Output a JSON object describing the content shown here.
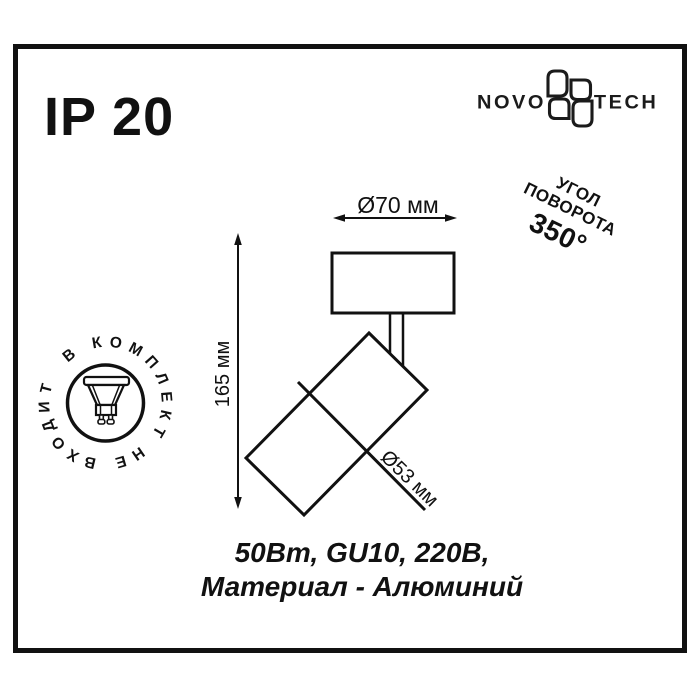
{
  "colors": {
    "ink": "#111111",
    "background": "#ffffff"
  },
  "ip_rating": "IP 20",
  "logo": {
    "name_left": "NOVO",
    "name_right": "TECH"
  },
  "rotation_badge": {
    "line1": "УГОЛ",
    "line2": "ПОВОРОТА",
    "angle": "350°"
  },
  "not_included_badge": {
    "circular_text": "В КОМПЛЕКТ НЕ ВХОДИТ"
  },
  "dimensions": {
    "mount_diameter": "Ø70 мм",
    "height": "165 мм",
    "body_diameter": "Ø53 мм"
  },
  "specs": {
    "line1": "50Вт, GU10, 220В,",
    "line2": "Материал - Алюминий"
  }
}
